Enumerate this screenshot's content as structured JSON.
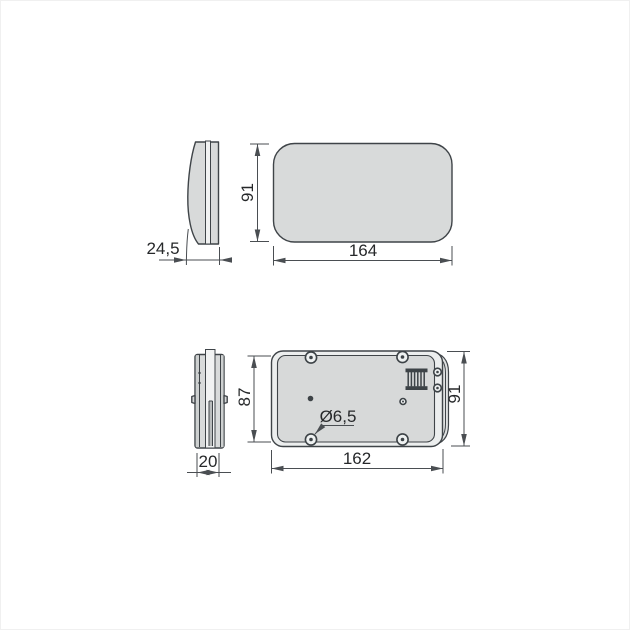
{
  "drawing": {
    "type": "technical-drawing",
    "description": "Two-view dimensioned CAD drawing of a rounded rectangular cover: side profile and front face (top), side profile and back panel with screw holes and vent grill (bottom)",
    "colors": {
      "background": "#ffffff",
      "outline": "#3f4448",
      "part_fill": "#d8dada",
      "panel_fill": "#eceeee",
      "inner_fill": "#d7d9d9",
      "strip_fill": "#f1f2f2",
      "bulge_fill": "#e0e2e2",
      "detail": "#3d4347",
      "dim_line": "#4a4e52",
      "text": "#26282a"
    }
  },
  "dimensions": {
    "top_depth": "24,5",
    "top_height": "91",
    "top_width": "164",
    "bottom_depth": "20",
    "bottom_inner_height": "87",
    "bottom_outer_height": "91",
    "bottom_width": "162",
    "hole_diameter": "Ø6,5"
  }
}
